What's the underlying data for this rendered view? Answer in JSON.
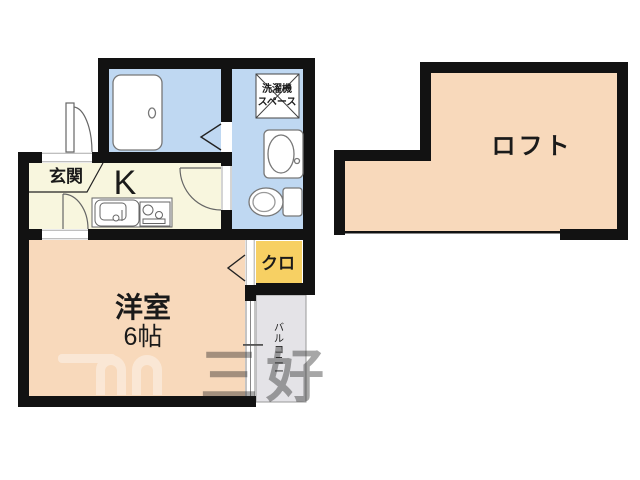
{
  "plan": {
    "labels": {
      "entrance": "玄関",
      "kitchen": "K",
      "washer_line1": "洗濯機",
      "washer_line2": "スペース",
      "closet": "クロ",
      "western_room": "洋室",
      "western_room_size": "6帖",
      "loft": "ロフト",
      "balcony": "バルコニー"
    },
    "watermark": "三好",
    "colors": {
      "wall": "#121212",
      "wet_area": "#bfd8f2",
      "kitchen_floor": "#f8f6de",
      "room_floor": "#f8d9bb",
      "closet_floor": "#f7d063",
      "balcony_floor": "#e4e3e7",
      "fixture_stroke": "#777777",
      "door_stroke": "#666666",
      "threshold": "#aaaaaa"
    }
  }
}
